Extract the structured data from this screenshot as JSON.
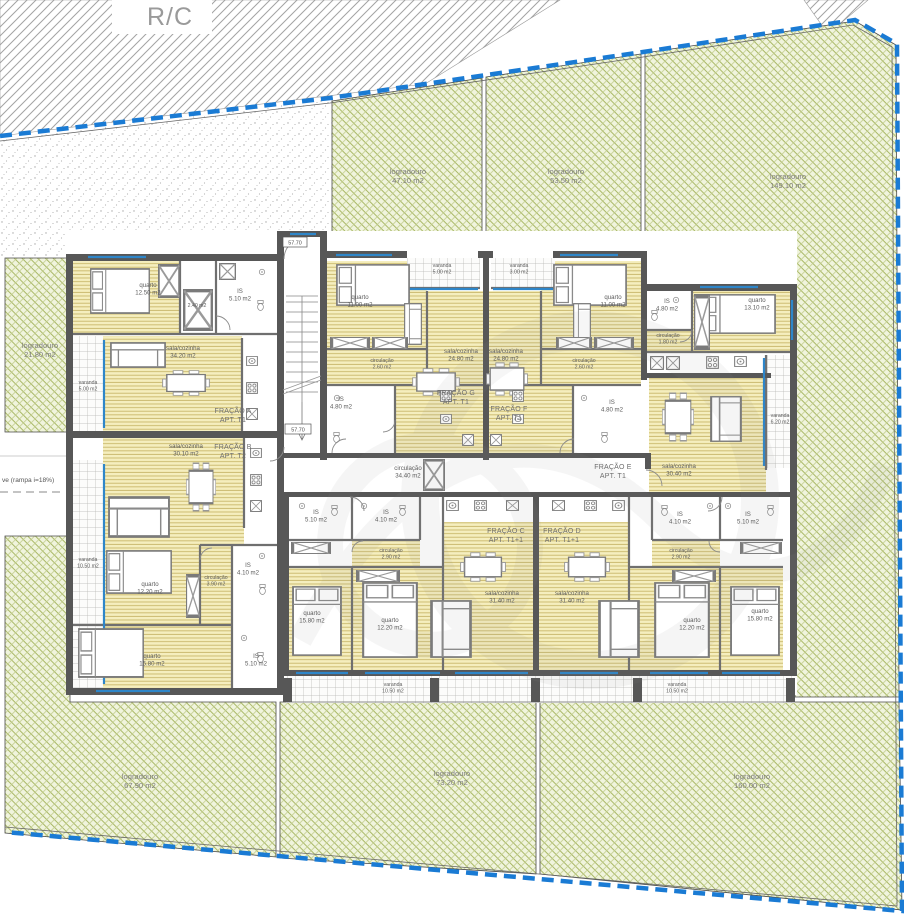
{
  "title": "R/C",
  "site": {
    "ramp_note": "ve (rampa i=18%)",
    "level_mark_top": "57.70",
    "level_mark_stairs": "57.70",
    "boundary_color": "#1a7bd4",
    "logradouros": [
      {
        "name": "logradouro",
        "area": "47.10 m2"
      },
      {
        "name": "logradouro",
        "area": "53.50 m2"
      },
      {
        "name": "logradouro",
        "area": "149.10 m2"
      },
      {
        "name": "logradouro",
        "area": "21.80 m2"
      },
      {
        "name": "logradouro",
        "area": "67.90 m2"
      },
      {
        "name": "logradouro",
        "area": "73.20 m2"
      },
      {
        "name": "logradouro",
        "area": "160.00 m2"
      }
    ]
  },
  "fractions": [
    {
      "name": "FRAÇÃO A",
      "apt": "APT. T1"
    },
    {
      "name": "FRAÇÃO B",
      "apt": "APT. T2"
    },
    {
      "name": "FRAÇÃO C",
      "apt": "APT. T1+1"
    },
    {
      "name": "FRAÇÃO D",
      "apt": "APT. T1+1"
    },
    {
      "name": "FRAÇÃO E",
      "apt": "APT. T1"
    },
    {
      "name": "FRAÇÃO F",
      "apt": "APT. T1"
    },
    {
      "name": "FRAÇÃO G",
      "apt": "APT. T1"
    }
  ],
  "rooms": [
    {
      "name": "quarto",
      "area": "12.50 m2"
    },
    {
      "name": "",
      "area": "2.40 m2"
    },
    {
      "name": "IS",
      "area": "5.10 m2"
    },
    {
      "name": "sala/cozinha",
      "area": "34.20 m2"
    },
    {
      "name": "varanda",
      "area": "5.00 m2"
    },
    {
      "name": "sala/cozinha",
      "area": "30.10 m2"
    },
    {
      "name": "IS",
      "area": "4.10 m2"
    },
    {
      "name": "circulação",
      "area": "3.90 m2"
    },
    {
      "name": "quarto",
      "area": "12.20 m2"
    },
    {
      "name": "quarto",
      "area": "15.80 m2"
    },
    {
      "name": "IS",
      "area": "5.10 m2"
    },
    {
      "name": "varanda",
      "area": "10.50 m2"
    },
    {
      "name": "varanda",
      "area": "5.00 m2"
    },
    {
      "name": "quarto",
      "area": "11.00 m2"
    },
    {
      "name": "circulação",
      "area": "2.60 m2"
    },
    {
      "name": "IS",
      "area": "4.80 m2"
    },
    {
      "name": "sala/cozinha",
      "area": "24.80 m2"
    },
    {
      "name": "varanda",
      "area": "3.00 m2"
    },
    {
      "name": "quarto",
      "area": "11.00 m2"
    },
    {
      "name": "circulação",
      "area": "2.60 m2"
    },
    {
      "name": "IS",
      "area": "4.80 m2"
    },
    {
      "name": "sala/cozinha",
      "area": "24.80 m2"
    },
    {
      "name": "IS",
      "area": "4.80 m2"
    },
    {
      "name": "circulação",
      "area": "1.80 m2"
    },
    {
      "name": "quarto",
      "area": "13.10 m2"
    },
    {
      "name": "sala/cozinha",
      "area": "30.40 m2"
    },
    {
      "name": "varanda",
      "area": "6.20 m2"
    },
    {
      "name": "circulação",
      "area": "34.40 m2"
    },
    {
      "name": "IS",
      "area": "5.10 m2"
    },
    {
      "name": "IS",
      "area": "4.10 m2"
    },
    {
      "name": "circulação",
      "area": "2.90 m2"
    },
    {
      "name": "quarto",
      "area": "15.80 m2"
    },
    {
      "name": "quarto",
      "area": "12.20 m2"
    },
    {
      "name": "sala/cozinha",
      "area": "31.40 m2"
    },
    {
      "name": "varanda",
      "area": "10.50 m2"
    },
    {
      "name": "IS",
      "area": "4.10 m2"
    },
    {
      "name": "IS",
      "area": "5.10 m2"
    },
    {
      "name": "circulação",
      "area": "2.90 m2"
    },
    {
      "name": "quarto",
      "area": "12.20 m2"
    },
    {
      "name": "quarto",
      "area": "15.80 m2"
    },
    {
      "name": "sala/cozinha",
      "area": "31.40 m2"
    },
    {
      "name": "varanda",
      "area": "10.50 m2"
    }
  ]
}
